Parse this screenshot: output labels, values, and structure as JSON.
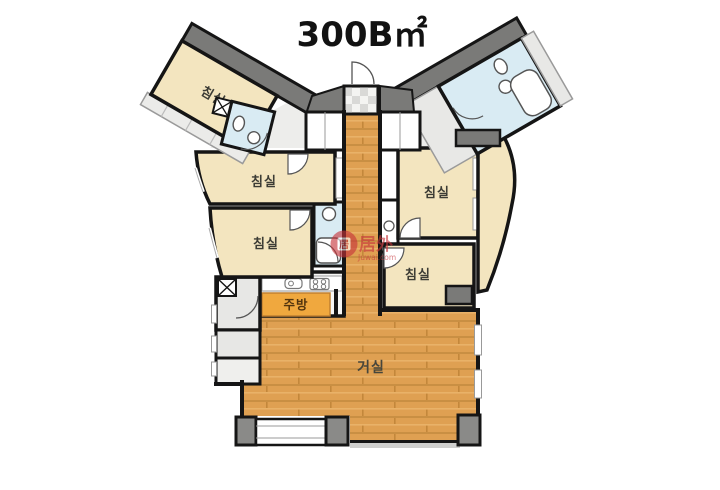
{
  "title": "300B㎡",
  "rooms": {
    "bedroom_wing_left": {
      "label": "침실"
    },
    "bedroom_left_upper": {
      "label": "침실"
    },
    "bedroom_left_lower": {
      "label": "침실"
    },
    "bedroom_right_upper": {
      "label": "침실"
    },
    "bedroom_right_lower": {
      "label": "침실"
    },
    "kitchen": {
      "label": "주방"
    },
    "living_room": {
      "label": "거실"
    }
  },
  "watermark": {
    "logo_char": "居",
    "brand": "居外",
    "domain": "Juwai.com"
  },
  "colors": {
    "wall": "#151515",
    "bedroom_floor": "#f3e5bf",
    "wood_floor": "#dfa052",
    "bathroom_floor": "#d9ebf3",
    "kitchen_counter": "#f0a83e",
    "dark_gray": "#7a7a78",
    "light_gray": "#e7e7e5",
    "watermark_red": "#c6343a"
  }
}
